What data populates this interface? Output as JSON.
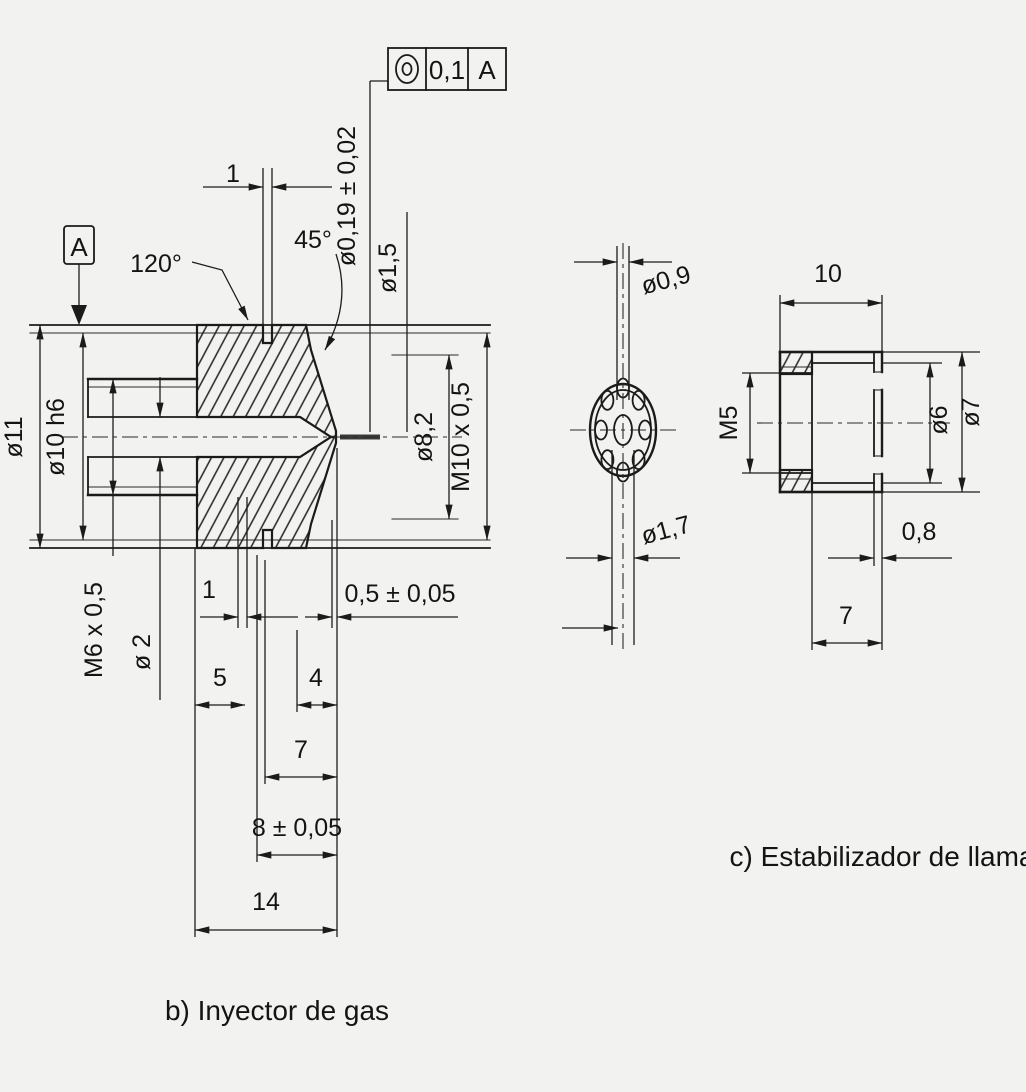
{
  "drawing": {
    "captions": {
      "injector": "b) Inyector de gas",
      "stabilizer": "c) Estabilizador de llama"
    },
    "injector": {
      "datum": "A",
      "feature_control_frame": {
        "symbol": "concentricity",
        "tolerance": "0,1",
        "datum_ref": "A"
      },
      "labels": {
        "groove_width_top": "1",
        "chamfer_angle": "45°",
        "cone_angle": "120°",
        "orifice_dia": "ø0,19 ± 0,02",
        "counterbore_dia": "ø1,5",
        "outer_dia": "ø11",
        "body_dia": "ø10 h6",
        "thread_left": "M6 x 0,5",
        "bore_dia": "ø 2",
        "thread_bore_dia": "ø8,2",
        "thread_right": "M10 x 0,5",
        "undercut_width": "1",
        "orifice_length": "0,5 ± 0,05",
        "len_5": "5",
        "len_4": "4",
        "len_7": "7",
        "len_8": "8 ± 0,05",
        "len_14": "14"
      }
    },
    "stabilizer": {
      "front": {
        "hole_dia": "ø0,9",
        "center_hole_dia": "ø1,7"
      },
      "side": {
        "len_10": "10",
        "thread": "M5",
        "inner_dia": "ø6",
        "outer_dia": "ø7",
        "wall": "0,8",
        "len_7": "7"
      }
    }
  }
}
